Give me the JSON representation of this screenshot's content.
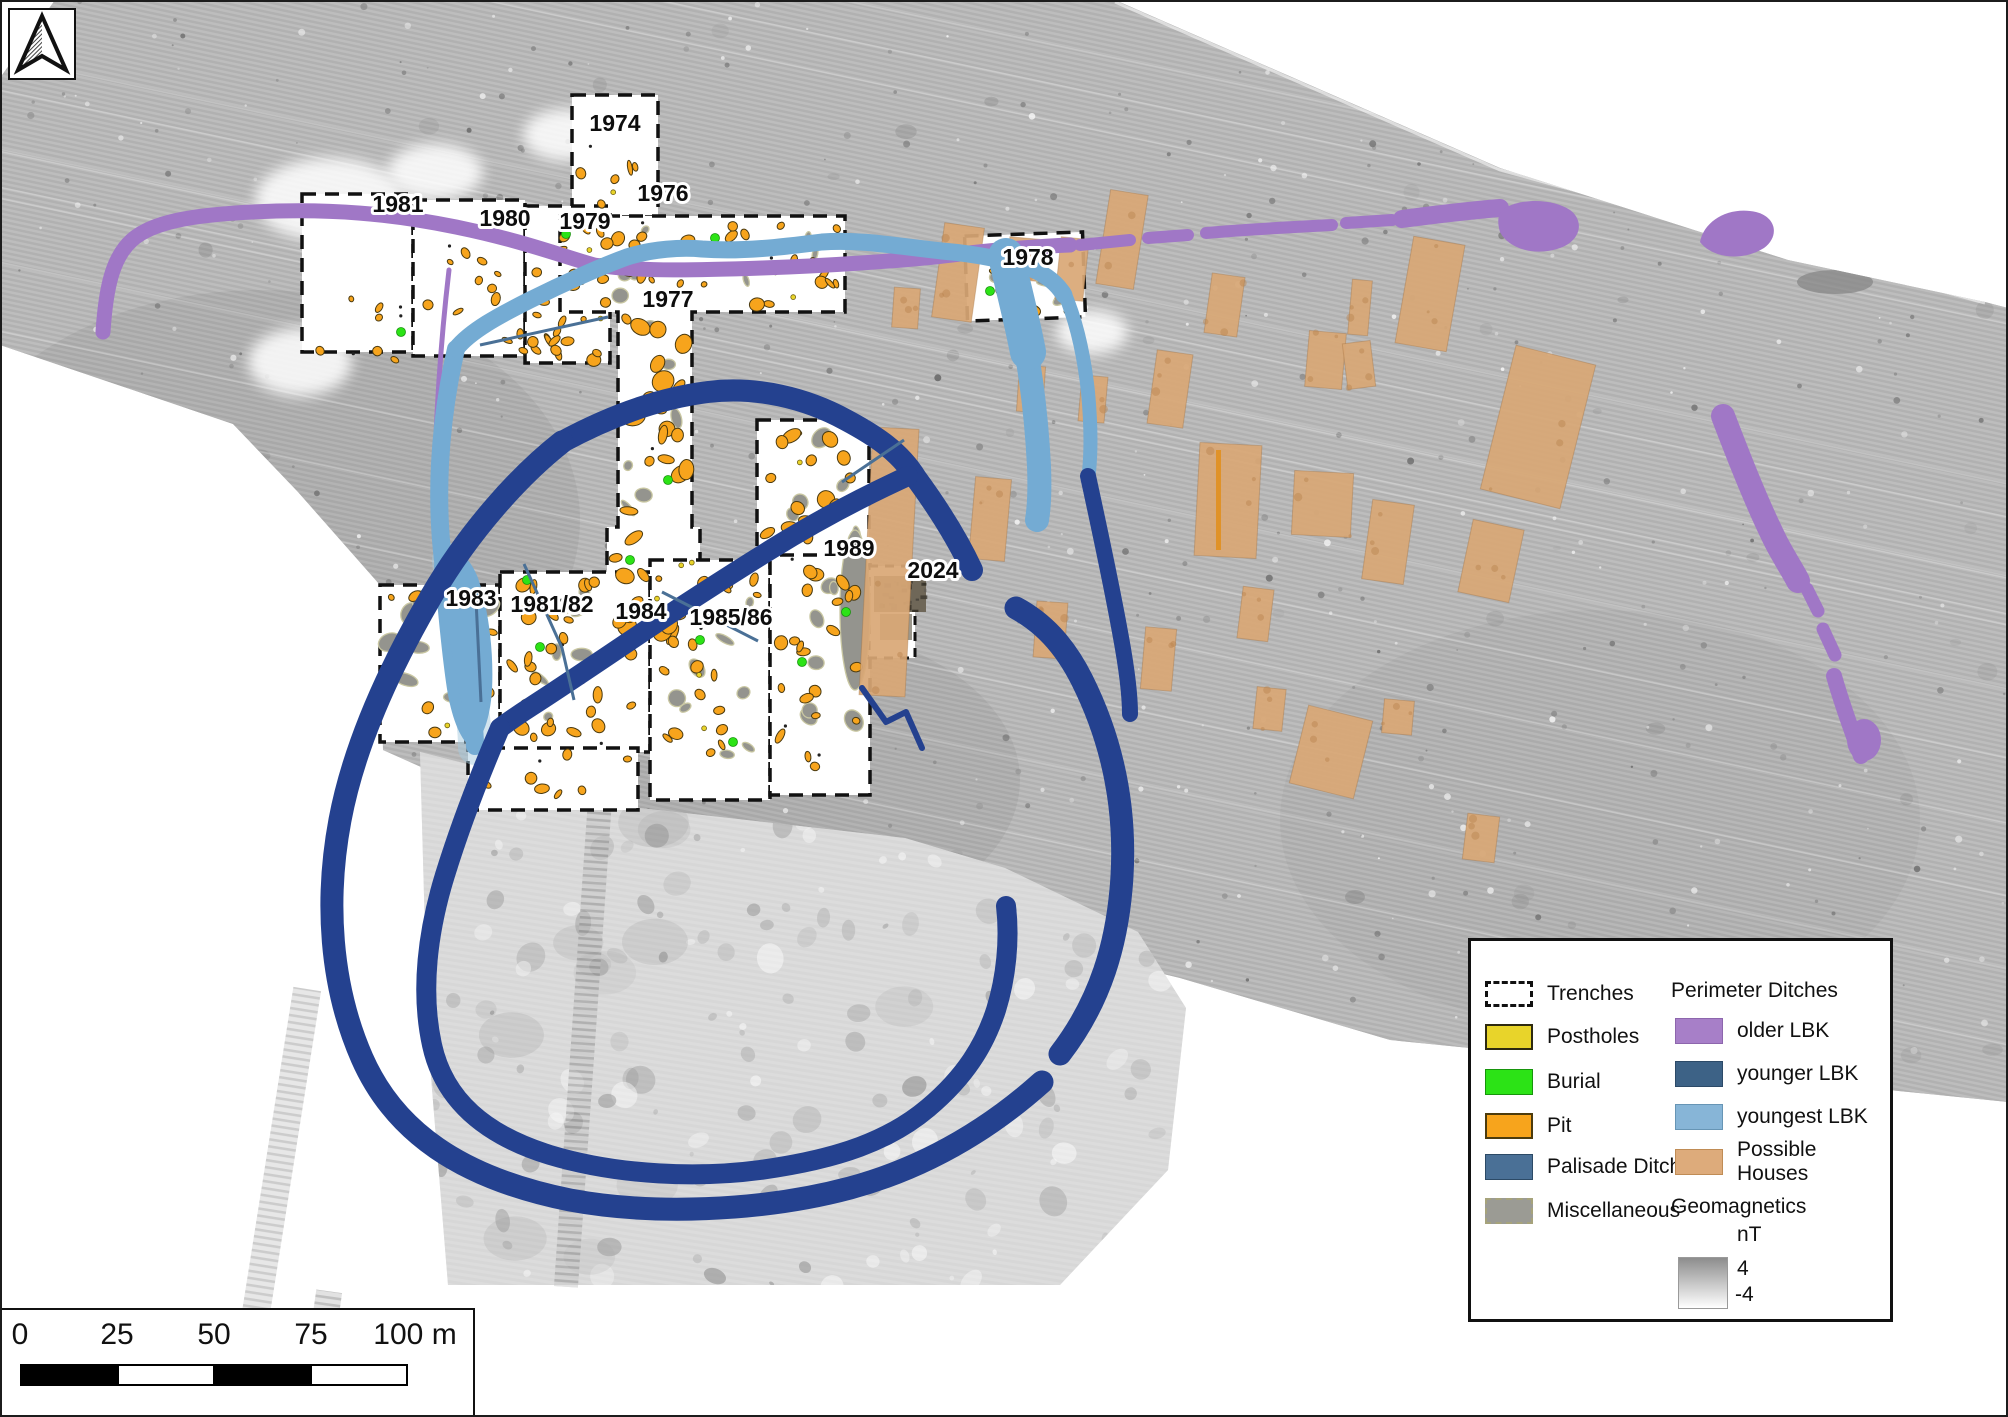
{
  "figure": {
    "type": "archaeological geomagnetics site map",
    "colors": {
      "survey_band": "#b7b7b7",
      "survey_lower_patch": "#dadada",
      "trench_fill": "#ffffff",
      "posthole": "#e8d42a",
      "burial": "#2ce316",
      "pit": "#f7a41c",
      "palisade_ditch": "#4a7096",
      "miscellaneous": "#94948e",
      "older_lbk": "#a077c6",
      "younger_lbk_map": "#24418f",
      "younger_lbk_legend": "#3d6286",
      "youngest_lbk": "#74abd3",
      "possible_houses": "#d9a876"
    }
  },
  "trench_labels": [
    {
      "text": "1974",
      "x": 615,
      "y": 131
    },
    {
      "text": "1976",
      "x": 663,
      "y": 201
    },
    {
      "text": "1977",
      "x": 668,
      "y": 307
    },
    {
      "text": "1978",
      "x": 1028,
      "y": 265
    },
    {
      "text": "1979",
      "x": 585,
      "y": 229
    },
    {
      "text": "1980",
      "x": 505,
      "y": 226
    },
    {
      "text": "1981",
      "x": 398,
      "y": 212
    },
    {
      "text": "1983",
      "x": 471,
      "y": 606
    },
    {
      "text": "1981/82",
      "x": 552,
      "y": 612
    },
    {
      "text": "1984",
      "x": 641,
      "y": 619
    },
    {
      "text": "1985/86",
      "x": 731,
      "y": 625
    },
    {
      "text": "1989",
      "x": 849,
      "y": 556
    },
    {
      "text": "2024",
      "x": 933,
      "y": 578
    }
  ],
  "legend": {
    "left": [
      {
        "label": "Trenches",
        "swatch": "trenches"
      },
      {
        "label": "Postholes",
        "swatch": "postholes"
      },
      {
        "label": "Burial",
        "swatch": "burial"
      },
      {
        "label": "Pit",
        "swatch": "pit"
      },
      {
        "label": "Palisade Ditch",
        "swatch": "palisade"
      },
      {
        "label": "Miscellaneous",
        "swatch": "misc"
      }
    ],
    "right_header": "Perimeter Ditches",
    "right": [
      {
        "label": "older LBK",
        "swatch": "older"
      },
      {
        "label": "younger LBK",
        "swatch": "younger"
      },
      {
        "label": "youngest LBK",
        "swatch": "youngest"
      },
      {
        "label": "Possible Houses",
        "swatch": "houses"
      }
    ],
    "geomagnetics": {
      "title": "Geomagnetics",
      "unit": "nT",
      "max": "4",
      "min": "-4"
    }
  },
  "scalebar": {
    "ticks": [
      "0",
      "25",
      "50",
      "75"
    ],
    "end_tick": "100 m"
  }
}
